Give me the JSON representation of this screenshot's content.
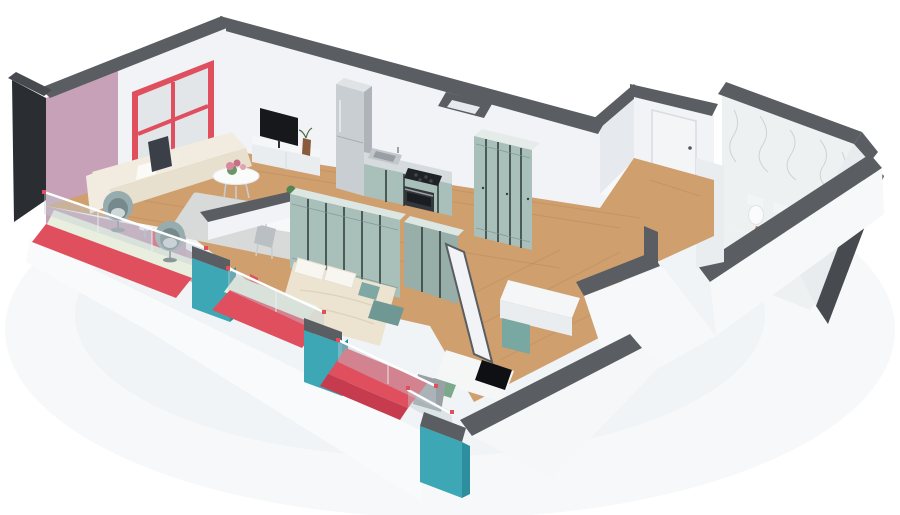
{
  "scene": {
    "kind": "3d-floor-plan-render",
    "style": "isometric dollhouse cutaway, no ceiling, white background",
    "background": "#ffffff"
  },
  "palette": {
    "wallWhite": "#f1f3f6",
    "wallShade": "#e6eaee",
    "outerWhite": "#f6f8fa",
    "capGray": "#5a5e62",
    "capGrayDark": "#474b4f",
    "outerBlack": "#2a2d31",
    "mauve": "#c7a1b7",
    "red": "#e04f5e",
    "redDeep": "#c63c4e",
    "teal": "#3da7b6",
    "tealDark": "#2d8e9e",
    "sage": "#a9bfb9",
    "sageDark": "#98aea8",
    "mint": "#e9efdf",
    "glass": "rgba(193,206,213,0.42)",
    "wood": "#cf9f6e",
    "rug": "#d8dad9",
    "sofaCream": "#f2ece0",
    "sofaShade": "#e7e0cf",
    "duvet": "#ece4d1",
    "marble": "#eef1f2",
    "tvBlack": "#16181c",
    "steel": "#c9ced2",
    "steelDark": "#aeb4b9",
    "whiteFixture": "#fafbfc",
    "plantGreen": "#5d8a57",
    "flowerPink": "#d9899e",
    "pillowGreen": "#7aa98c",
    "headboardGray": "#9aa0a4",
    "vanityWood": "#b97f43",
    "tealFurniture": "#79a8a2",
    "chairTeal": "#a9c4c6",
    "floorTile": "#eef1f2",
    "groundShadow": "#eef2f4"
  },
  "rooms": [
    {
      "id": "living-room",
      "furniture": [
        "corner-sofa",
        "pillows",
        "wall-art",
        "round-coffee-table",
        "flower-vase",
        "area-rug",
        "tv",
        "tv-console",
        "decor-vase",
        "red-frame-window"
      ]
    },
    {
      "id": "dining-area",
      "furniture": [
        "dining-table",
        "potted-plant",
        "teal-chairs",
        "gray-chair"
      ]
    },
    {
      "id": "kitchen",
      "furniture": [
        "fridge",
        "sink",
        "cooktop",
        "oven",
        "sage-cabinets"
      ]
    },
    {
      "id": "hallway",
      "furniture": [
        "five-door-wardrobe"
      ]
    },
    {
      "id": "master-bedroom",
      "furniture": [
        "double-bed",
        "pillows",
        "teal-bench",
        "wardrobe-row-north",
        "wardrobe-row-east"
      ]
    },
    {
      "id": "kids-bedroom",
      "furniture": [
        "single-bed",
        "green-pillow",
        "gray-headboard",
        "desk",
        "teal-cabinet"
      ]
    },
    {
      "id": "bathroom",
      "furniture": [
        "toilet",
        "bidet",
        "wood-vanity",
        "marble-walls"
      ]
    },
    {
      "id": "entrance",
      "furniture": [
        "entry-door"
      ]
    },
    {
      "id": "balconies",
      "furniture": [
        "egg-chair-1",
        "egg-chair-2",
        "side-table",
        "glass-railings",
        "teal-pillars",
        "red-floors",
        "mint-floors"
      ]
    }
  ]
}
